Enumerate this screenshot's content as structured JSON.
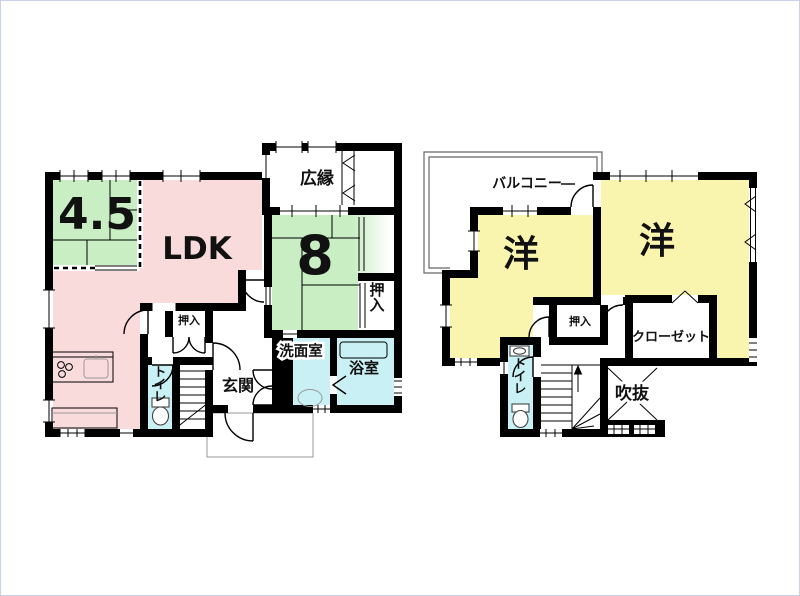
{
  "colors": {
    "wall": "#000000",
    "tatami_green": "#c9eec4",
    "ldk_pink": "#f9dbdb",
    "western_yellow": "#faf5ae",
    "wet_cyan": "#c9f0f4",
    "tub_cyan": "#7ce4f0",
    "page_border": "#c9d0ea"
  },
  "floor1": {
    "rooms": {
      "tatami_4_5": "4.5",
      "ldk": "LDK",
      "tatami_8": "8",
      "hiroen": "広縁",
      "oshiire_east": "押入",
      "oshiire_center": "押入",
      "senmenshitsu": "洗面室",
      "yokushitsu": "浴室",
      "genkan": "玄関",
      "toire": "トイレ"
    }
  },
  "floor2": {
    "rooms": {
      "balcony": "バルコニー",
      "western_left": "洋",
      "western_right": "洋",
      "oshiire": "押入",
      "closet": "クローゼット",
      "toire": "トイレ",
      "fukinuke": "吹抜"
    }
  }
}
